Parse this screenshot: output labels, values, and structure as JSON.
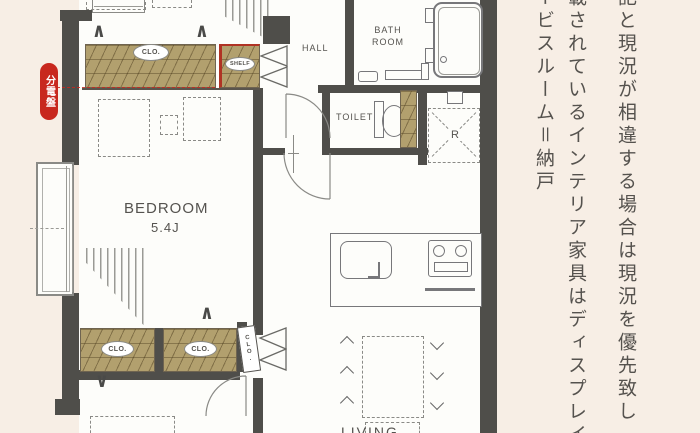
{
  "floor_plan": {
    "rooms": {
      "hall": "HALL",
      "bath_room": "BATH ROOM",
      "toilet": "TOILET",
      "bedroom": "BEDROOM",
      "bedroom_area": "5.4J",
      "living": "LIVING",
      "refrigerator_space": "R"
    },
    "storage": {
      "closet_top": "CLO.",
      "shelf": "SHELF",
      "closet_bottom_left": "CLO.",
      "closet_bottom_right": "CLO.",
      "closet_side": "CLO."
    },
    "badges": {
      "distribution_board": "分電盤"
    },
    "colors": {
      "background": "#f7eee5",
      "wall": "#4f4e4a",
      "wood": "#b2a06e",
      "accent_red": "#c8281e",
      "line": "#77777a",
      "text": "#55534f"
    }
  },
  "side_note": {
    "columns": [
      "記と現況が相違する場合は現況を優先致し",
      "載されているインテリア家具はディスプレイ",
      "ービスルーム＝納戸"
    ]
  }
}
